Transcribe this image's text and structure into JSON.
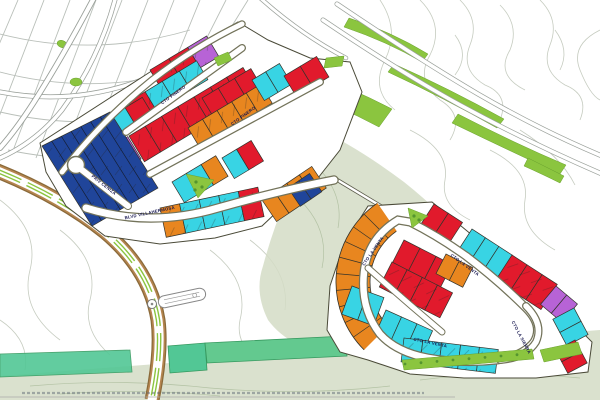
{
  "map": {
    "type": "residential lotification master plan with contour terrain",
    "streets": {
      "blvd_villahermosa": "BLVD VILLAHERMOSA",
      "cto_pinero_upper": "CTO PINERO",
      "cto_pinero_lower": "CTO PINERO",
      "priv_ceniza": "PRIV CENIZA",
      "cto_la_venta_west": "CTO LA VENTA",
      "cto_la_venta_northeast": "CTO LA VENTA",
      "cto_la_venta_south": "CTO LA VENTA",
      "cto_la_sierra": "CTO LA SIERRA"
    },
    "palette": {
      "red": "#e11a2c",
      "orange": "#e8861f",
      "cyan": "#38d4e4",
      "blue": "#20459a",
      "violet": "#b763d6",
      "green": "#8bc53f",
      "green_dark": "#55952f",
      "teal": "#52c795",
      "sage": "#d3dcc6",
      "contour": "#c6ccc0",
      "contour_dark": "#b3c2a4",
      "road_casing": "#73735a",
      "tan": "#b5854f",
      "tan_dark": "#8a6a3a",
      "gray_road": "#9aa09a",
      "label": "#15154e",
      "lot_stroke": "#33332b",
      "hull_stroke": "#4a4a38"
    }
  }
}
